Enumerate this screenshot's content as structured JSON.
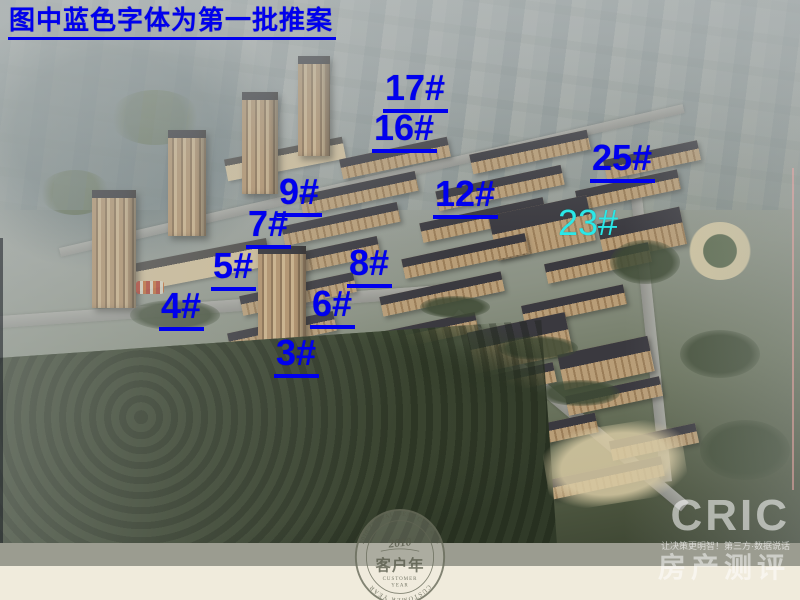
{
  "slide": {
    "note": "图中蓝色字体为第一批推案"
  },
  "annotations": {
    "first_batch_color": "#0000ee",
    "later_batch_color": "#2be8e8",
    "labels": [
      {
        "text": "17#",
        "x": 383,
        "y": 70,
        "batch": "first"
      },
      {
        "text": "16#",
        "x": 372,
        "y": 110,
        "batch": "first"
      },
      {
        "text": "25#",
        "x": 590,
        "y": 140,
        "batch": "first"
      },
      {
        "text": "9#",
        "x": 277,
        "y": 174,
        "batch": "first"
      },
      {
        "text": "12#",
        "x": 433,
        "y": 176,
        "batch": "first"
      },
      {
        "text": "7#",
        "x": 246,
        "y": 206,
        "batch": "first"
      },
      {
        "text": "23#",
        "x": 558,
        "y": 205,
        "batch": "later"
      },
      {
        "text": "8#",
        "x": 347,
        "y": 245,
        "batch": "first"
      },
      {
        "text": "5#",
        "x": 211,
        "y": 248,
        "batch": "first"
      },
      {
        "text": "6#",
        "x": 310,
        "y": 286,
        "batch": "first"
      },
      {
        "text": "4#",
        "x": 159,
        "y": 288,
        "batch": "first"
      },
      {
        "text": "3#",
        "x": 274,
        "y": 335,
        "batch": "first"
      }
    ]
  },
  "stamp": {
    "arc_top": "2010 ZENDAI IDEAL CITY 2010",
    "arc_bottom": "CUSTOMER YEAR",
    "year": "2010",
    "title_cn": "客户年",
    "subtitle_en_1": "CUSTOMER",
    "subtitle_en_2": "YEAR"
  },
  "watermark": {
    "brand": "CRIC",
    "tagline": "让决策更明智！第三方·数据说话",
    "product_cn": "房产测评"
  }
}
